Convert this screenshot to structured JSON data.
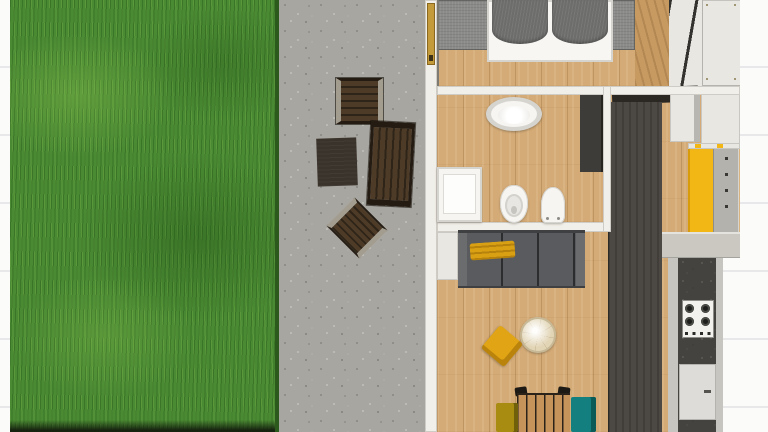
{
  "scene": {
    "type": "floor-plan-render",
    "view": "top-down",
    "label": "Apartment floor plan with garden lawn, gravel patio and furnished interior"
  },
  "palette": {
    "bg": "#fbfbfa",
    "line": "#e8e8eb",
    "grass": "#4a8a33",
    "grass_dark": "#2c5a1d",
    "grass_shadow": "#16230f",
    "gravel": "#a8a6a1",
    "gravel_dark": "#908e89",
    "gravel_light": "#bcbab5",
    "wood": "#d4ab77",
    "wood_dark": "#c79a62",
    "wall": "#f1efe9",
    "wall_shadow": "#cfccc5",
    "shadow_line": "#7d7a72",
    "door_gold": "#c49b3a",
    "rug": "#8b8b89",
    "duvet": "#6d6d6b",
    "bed_white": "#f7f6f3",
    "outdoor_dark": "#241c13",
    "outdoor_slat": "#4e3b27",
    "outdoor_slat_dark": "#2e2418",
    "mat": "#3a332b",
    "rail_light": "#a39d90",
    "sofa": "#595b5e",
    "sofa_dark": "#3e4042",
    "sofa_arm": "#6a6c6e",
    "throw_yellow": "#d9a013",
    "ottoman_yellow": "#e0a414",
    "cabinet_yellow": "#f2b715",
    "teal": "#13807f",
    "olive": "#a88c12",
    "table_wood": "#c6945b",
    "table_top": "#e2d5b6",
    "slat_dark": "#2b2219",
    "panel_dark": "#4c4944",
    "counter_dark": "#454340",
    "counter_edge": "#c7c5bf",
    "ledge": "#cbc8c2",
    "cab_white": "#e9e7e1",
    "cab_grey": "#b4b2ad",
    "fixture_white": "#f6f5f2",
    "fixture_rim": "#d6d4cf",
    "stove_white": "#f2f1ee",
    "burner": "#1e1e1c"
  },
  "regions": {
    "garden": {
      "label": "grass lawn"
    },
    "patio": {
      "label": "gravel patio",
      "furniture": [
        "wooden folding chair",
        "dark outdoor mat",
        "wooden lounger",
        "wooden folding chair rotated"
      ]
    },
    "bedroom": {
      "label": "bedroom",
      "furniture": [
        "double bed with two grey duvets",
        "grey rug",
        "wardrobe with drawer fronts",
        "gold patio door"
      ]
    },
    "bathroom": {
      "label": "bathroom",
      "fixtures": [
        "oval washbasin",
        "shower tray",
        "toilet",
        "bidet",
        "dark tall cabinet"
      ]
    },
    "living_room": {
      "label": "living room",
      "furniture": [
        "grey three-seat sofa with yellow throw",
        "round coffee table",
        "yellow ottoman",
        "slatted dining table",
        "olive chair",
        "teal chair",
        "white sideboard"
      ]
    },
    "kitchen": {
      "label": "kitchen strip",
      "fixtures": [
        "dark wall unit",
        "white box cabinet",
        "upper drawer panel",
        "yellow tall cabinet",
        "grey drawer unit",
        "dark speckled countertop",
        "four-burner gas hob",
        "white counter door"
      ]
    }
  }
}
